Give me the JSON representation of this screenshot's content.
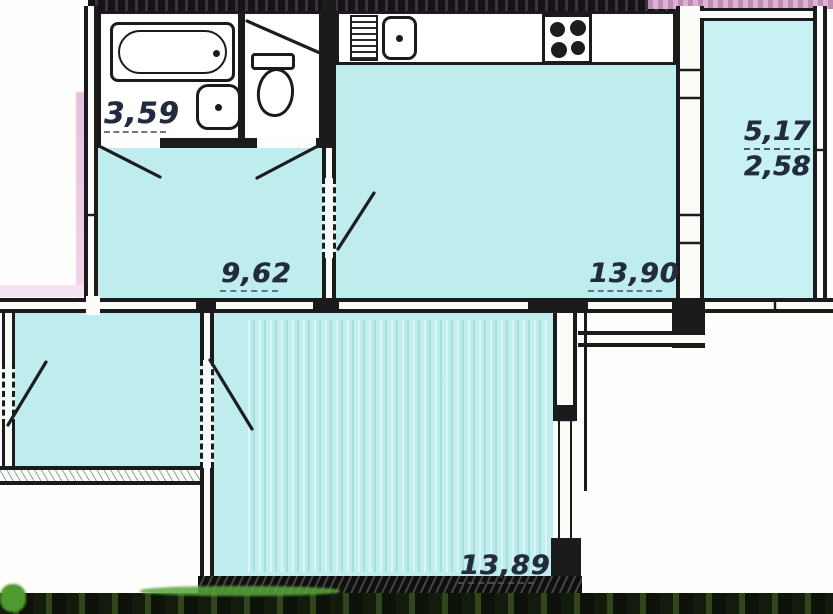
{
  "rooms": {
    "bathroom": {
      "label": "3,59"
    },
    "hallway": {
      "label": "9,62"
    },
    "kitchen": {
      "label": "13,90"
    },
    "room": {
      "label": "13,89"
    },
    "balcony": {
      "label_total": "5,17",
      "label_reduced": "2,58"
    }
  },
  "fixtures": {
    "bathtub": "bathtub",
    "bathroom_sink": "wash basin",
    "toilet": "toilet",
    "kitchen_sink": "kitchen sink",
    "stove": "4-burner stove",
    "drainboard": "counter drainboard"
  },
  "colors": {
    "floor_cyan": "#bfecec",
    "balcony_cyan": "#c7f1f2",
    "wall_ink": "#1b1b1b",
    "label_ink": "#222c3e",
    "top_scan_band": "#2b222c",
    "pink_scan_edge": "#cf9dc4",
    "bottom_scan_band": "#21330f",
    "grass_green": "#55a136"
  }
}
